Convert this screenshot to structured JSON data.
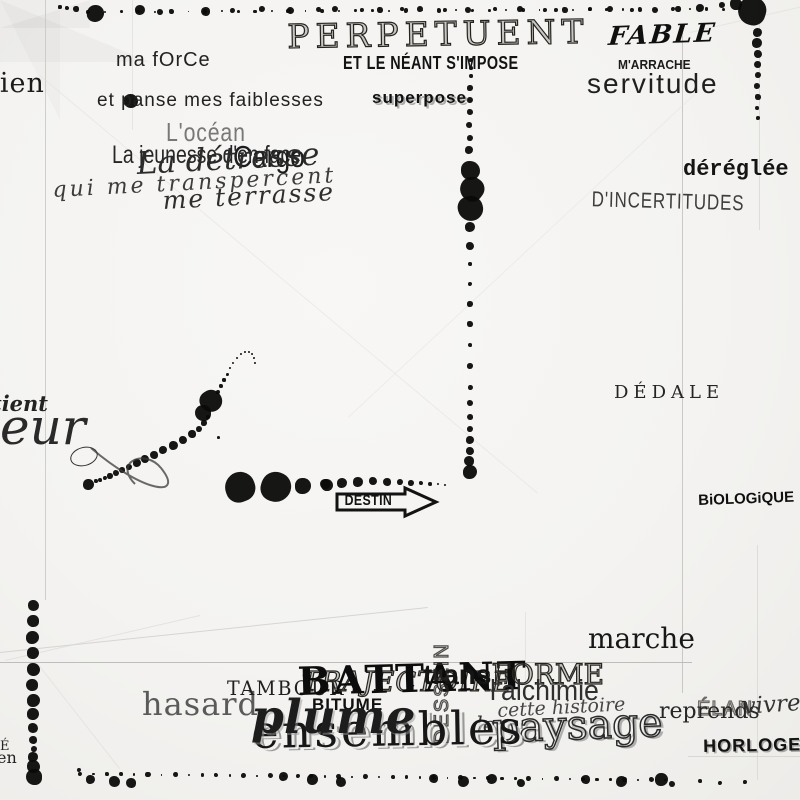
{
  "words": {
    "rien": "rien",
    "ma_force": "ma fOrCe",
    "panse": "et panse mes faiblesses",
    "ocean": "L'océan",
    "jeunesse": "La jeunesse d'en face",
    "cargo": "Cargo",
    "detresse": "La détresse",
    "qui": "qui me transpercent",
    "terrasse": "me terrasse",
    "perpetuent": "PERPETUENT",
    "neant": "ET LE NÉANT S'IMPOSE",
    "superpose": "superpose",
    "fable": "FABLE",
    "marrache": "M'ARRACHE",
    "servitude": "servitude",
    "dereglee": "déréglée",
    "incertitudes": "D'INCERTITUDES",
    "dedale": "DÉDALE",
    "biologique": "BiOLOGiQUE",
    "marche": "marche",
    "tient": "tient",
    "leur": "leur",
    "destin": "DESTIN",
    "tambour": "TAMBOUR",
    "trajectoire": "TRAJECTOIRE",
    "battant": "BATTANT",
    "bitume": "BITUME",
    "trans": "trans",
    "forme": "FORME",
    "dessein": "DESSEIN",
    "alchimie": "l'alchimie",
    "cette_histoire": "cette histoire",
    "le": "le",
    "paysage": "paysage",
    "ensembles": "ensembles",
    "plume": "plume",
    "hasard": "hasard",
    "reprends": "reprends",
    "elan": "ÉLAN",
    "vivre": "vivre",
    "horloge": "HORLOGE",
    "edge_fragment_1": "É",
    "edge_fragment_2": "en"
  },
  "colors": {
    "paper": "#f4f3f1",
    "ink": "#0d0d0b",
    "gray_text": "#5a5a5a"
  },
  "ink": {
    "groups": [
      {
        "row": [
          88,
          12,
          740,
          9,
          40,
          0.8,
          2.2
        ]
      },
      {
        "pts": [
          [
            60,
            7,
            1.6
          ],
          [
            67,
            8,
            2.2
          ],
          [
            76,
            9,
            2.6
          ],
          [
            95,
            13,
            8.5
          ],
          [
            140,
            10,
            5
          ],
          [
            160,
            12,
            3
          ],
          [
            205,
            11,
            4.5
          ],
          [
            232,
            10,
            2.5
          ],
          [
            262,
            9,
            3
          ],
          [
            290,
            10,
            3.5
          ],
          [
            318,
            9,
            2.5
          ],
          [
            335,
            9,
            3.2
          ],
          [
            362,
            10,
            2.2
          ],
          [
            380,
            10,
            2.6
          ],
          [
            402,
            9,
            2.2
          ],
          [
            420,
            9,
            3
          ],
          [
            445,
            10,
            2.4
          ],
          [
            468,
            10,
            3.4
          ],
          [
            495,
            9,
            2.4
          ],
          [
            520,
            9,
            3
          ],
          [
            545,
            10,
            2.3
          ],
          [
            565,
            10,
            2.6
          ],
          [
            590,
            9,
            2.2
          ],
          [
            610,
            9,
            3
          ],
          [
            632,
            10,
            2.4
          ],
          [
            655,
            10,
            3
          ],
          [
            678,
            9,
            2.6
          ],
          [
            700,
            8,
            4
          ],
          [
            722,
            5,
            3
          ],
          [
            736,
            4,
            6
          ],
          [
            752,
            11,
            14
          ]
        ]
      },
      {
        "pts": [
          [
            757,
            32,
            4.5
          ],
          [
            757,
            43,
            5
          ],
          [
            758,
            54,
            4
          ],
          [
            757,
            64,
            3.5
          ],
          [
            758,
            75,
            3
          ],
          [
            757,
            86,
            3.4
          ],
          [
            758,
            97,
            2.6
          ],
          [
            757,
            108,
            2.2
          ],
          [
            758,
            118,
            1.8
          ]
        ]
      },
      {
        "pts": [
          [
            471,
            60,
            1.8
          ],
          [
            471,
            68,
            1.8
          ],
          [
            471,
            76,
            1.8
          ],
          [
            470,
            88,
            2.6
          ],
          [
            470,
            100,
            3.2
          ],
          [
            470,
            112,
            2.8
          ],
          [
            469,
            125,
            3.2
          ],
          [
            470,
            138,
            3
          ],
          [
            469,
            150,
            4.4
          ],
          [
            470,
            170,
            9.5
          ],
          [
            472,
            189,
            12
          ],
          [
            470,
            208,
            12.5
          ],
          [
            470,
            227,
            5
          ],
          [
            470,
            246,
            4.2
          ],
          [
            470,
            264,
            1.8
          ],
          [
            470,
            284,
            2.4
          ],
          [
            470,
            304,
            2.6
          ],
          [
            470,
            324,
            2.6
          ],
          [
            470,
            345,
            2.4
          ],
          [
            470,
            366,
            2.7
          ],
          [
            470,
            387,
            2.5
          ],
          [
            470,
            403,
            2.9
          ],
          [
            470,
            417,
            3
          ],
          [
            470,
            429,
            3.4
          ],
          [
            470,
            440,
            3.8
          ],
          [
            470,
            451,
            4.4
          ],
          [
            469,
            461,
            5
          ],
          [
            470,
            472,
            6.8
          ]
        ]
      },
      {
        "pts": [
          [
            88,
            484,
            5.5
          ],
          [
            96,
            481,
            1.8
          ],
          [
            100,
            480,
            2
          ],
          [
            105,
            478,
            2.3
          ],
          [
            110,
            476,
            2.6
          ],
          [
            116,
            473,
            2.9
          ],
          [
            122,
            470,
            3.1
          ],
          [
            129,
            467,
            3.4
          ],
          [
            137,
            463,
            3.7
          ],
          [
            145,
            459,
            3.9
          ],
          [
            154,
            455,
            4.1
          ],
          [
            163,
            450,
            4.3
          ],
          [
            173,
            445,
            4.5
          ],
          [
            183,
            440,
            4.2
          ],
          [
            192,
            434,
            3.6
          ],
          [
            199,
            429,
            3
          ],
          [
            204,
            423,
            2.6
          ],
          [
            208,
            417,
            2.4
          ],
          [
            203,
            413,
            8
          ],
          [
            211,
            401,
            11
          ],
          [
            218,
            392,
            2
          ],
          [
            221,
            386,
            1.8
          ],
          [
            224,
            380,
            1.6
          ],
          [
            227,
            374,
            1.5
          ],
          [
            230,
            368,
            1.4
          ],
          [
            233,
            363,
            1.3
          ],
          [
            237,
            358,
            1.2
          ],
          [
            241,
            354,
            1.1
          ],
          [
            245,
            352,
            1
          ],
          [
            249,
            352,
            1
          ],
          [
            252,
            354,
            1.1
          ],
          [
            254,
            358,
            1.2
          ],
          [
            255,
            363,
            1.3
          ],
          [
            218,
            437,
            1.5
          ]
        ]
      },
      {
        "pts": [
          [
            240,
            487,
            15
          ],
          [
            276,
            487,
            15
          ],
          [
            303,
            486,
            8
          ],
          [
            327,
            485,
            6
          ]
        ]
      },
      {
        "pts": [
          [
            325,
            484,
            5
          ],
          [
            342,
            483,
            5
          ],
          [
            358,
            482,
            4.6
          ],
          [
            373,
            481,
            4.2
          ],
          [
            387,
            482,
            3.7
          ],
          [
            400,
            482,
            3.2
          ],
          [
            411,
            483,
            2.7
          ],
          [
            421,
            483,
            2.2
          ],
          [
            430,
            484,
            1.8
          ],
          [
            438,
            484,
            1.4
          ],
          [
            445,
            485,
            1.1
          ]
        ]
      },
      {
        "pts": [
          [
            33,
            605,
            5.5
          ],
          [
            33,
            621,
            6
          ],
          [
            32,
            637,
            6.5
          ],
          [
            33,
            653,
            6
          ],
          [
            33,
            669,
            6.5
          ],
          [
            32,
            685,
            6
          ],
          [
            33,
            700,
            6.5
          ],
          [
            33,
            714,
            6
          ],
          [
            33,
            728,
            5
          ],
          [
            33,
            740,
            4
          ],
          [
            34,
            749,
            3
          ],
          [
            33,
            757,
            4.6
          ],
          [
            33,
            766,
            6.5
          ],
          [
            34,
            777,
            8
          ]
        ]
      },
      {
        "row": [
          80,
          774,
          665,
          780,
          44,
          0.8,
          2.6
        ]
      },
      {
        "pts": [
          [
            79,
            770,
            2
          ],
          [
            90,
            779,
            4.5
          ],
          [
            114,
            781,
            5.5
          ],
          [
            131,
            783,
            5
          ],
          [
            283,
            776,
            4.5
          ],
          [
            312,
            779,
            5.5
          ],
          [
            341,
            782,
            5
          ],
          [
            433,
            778,
            4.5
          ],
          [
            463,
            781,
            5.5
          ],
          [
            492,
            779,
            5
          ],
          [
            521,
            783,
            4
          ],
          [
            585,
            779,
            4.5
          ],
          [
            621,
            781,
            5.5
          ],
          [
            661,
            779,
            6.5
          ],
          [
            672,
            784,
            3
          ],
          [
            700,
            781,
            2
          ],
          [
            720,
            783,
            2.4
          ],
          [
            745,
            782,
            2
          ]
        ]
      },
      {
        "pts": [
          [
            131,
            101,
            7
          ]
        ]
      },
      {
        "ring": [
          70,
          447,
          26,
          17,
          -15
        ]
      }
    ]
  },
  "creases": [
    [
      45,
      0,
      600,
      90,
      1.2,
      "#c9c7c3",
      0.85
    ],
    [
      132,
      0,
      130,
      90,
      1,
      "#dcdad6",
      0.6
    ],
    [
      682,
      28,
      665,
      90,
      1.2,
      "#c3c1bd",
      0.85
    ],
    [
      759,
      0,
      230,
      90,
      1,
      "#d6d4d0",
      0.7
    ],
    [
      757,
      545,
      235,
      90,
      1,
      "#d6d4d0",
      0.7
    ],
    [
      525,
      612,
      92,
      90,
      1,
      "#dcdad6",
      0.6
    ],
    [
      0,
      662,
      692,
      0,
      1.4,
      "#b9b7b3",
      0.9
    ],
    [
      688,
      756,
      112,
      0,
      1,
      "#d1cfca",
      0.75
    ],
    [
      0,
      652,
      430,
      -6,
      1.1,
      "#cfcdc9",
      0.8
    ],
    [
      5,
      660,
      200,
      -13,
      1,
      "#d9d7d3",
      0.6
    ],
    [
      40,
      666,
      130,
      52,
      1,
      "#dcdad6",
      0.55
    ],
    [
      690,
      32,
      115,
      -13,
      1,
      "#dcdad6",
      0.55
    ],
    [
      40,
      75,
      650,
      40,
      1,
      "#e2e0dc",
      0.5
    ],
    [
      700,
      90,
      480,
      137,
      1,
      "#e2e0dc",
      0.45
    ]
  ]
}
